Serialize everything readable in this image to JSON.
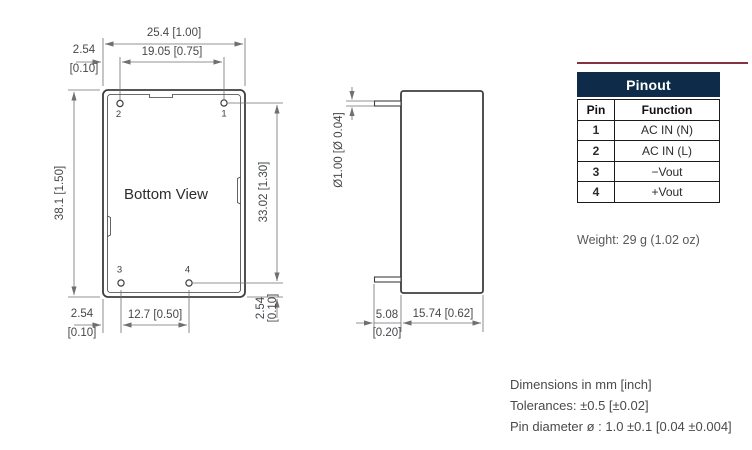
{
  "drawing": {
    "bottom_view": {
      "label": "Bottom View",
      "pin_labels": {
        "p1": "1",
        "p2": "2",
        "p3": "3",
        "p4": "4"
      },
      "dims": {
        "body_width": "25.4 [1.00]",
        "pin_pitch_horizontal": "19.05 [0.75]",
        "edge_offset_top_mm": "2.54",
        "edge_offset_top_in": "[0.10]",
        "body_height": "38.1 [1.50]",
        "pin_pitch_vertical": "33.02 [1.30]",
        "edge_offset_right_mm": "2.54",
        "edge_offset_right_in": "[0.10]",
        "pin_pitch_bottom": "12.7 [0.50]",
        "edge_offset_bottom_mm": "2.54",
        "edge_offset_bottom_in": "[0.10]"
      }
    },
    "side_view": {
      "dims": {
        "pin_diameter": "Ø1.00 [Ø 0.04]",
        "pin_length_mm": "5.08",
        "pin_length_in": "[0.20]",
        "body_depth": "15.74 [0.62]"
      }
    }
  },
  "pinout_table": {
    "title": "Pinout",
    "col_pin": "Pin",
    "col_function": "Function",
    "rows": [
      {
        "pin": "1",
        "function": "AC IN (N)"
      },
      {
        "pin": "2",
        "function": "AC IN (L)"
      },
      {
        "pin": "3",
        "function": "−Vout"
      },
      {
        "pin": "4",
        "function": "+Vout"
      }
    ]
  },
  "weight_note": "Weight: 29 g (1.02 oz)",
  "footnotes": {
    "line1": "Dimensions in mm [inch]",
    "line2": "Tolerances: ±0.5 [±0.02]",
    "line3": "Pin diameter ø : 1.0 ±0.1 [0.04 ±0.004]"
  },
  "colors": {
    "table_header_bg": "#0e2b49",
    "table_header_text": "#ffffff",
    "accent_rule": "#84343f",
    "drawing_line": "#3e3e3e",
    "dimension_line": "#6f6f6f"
  }
}
